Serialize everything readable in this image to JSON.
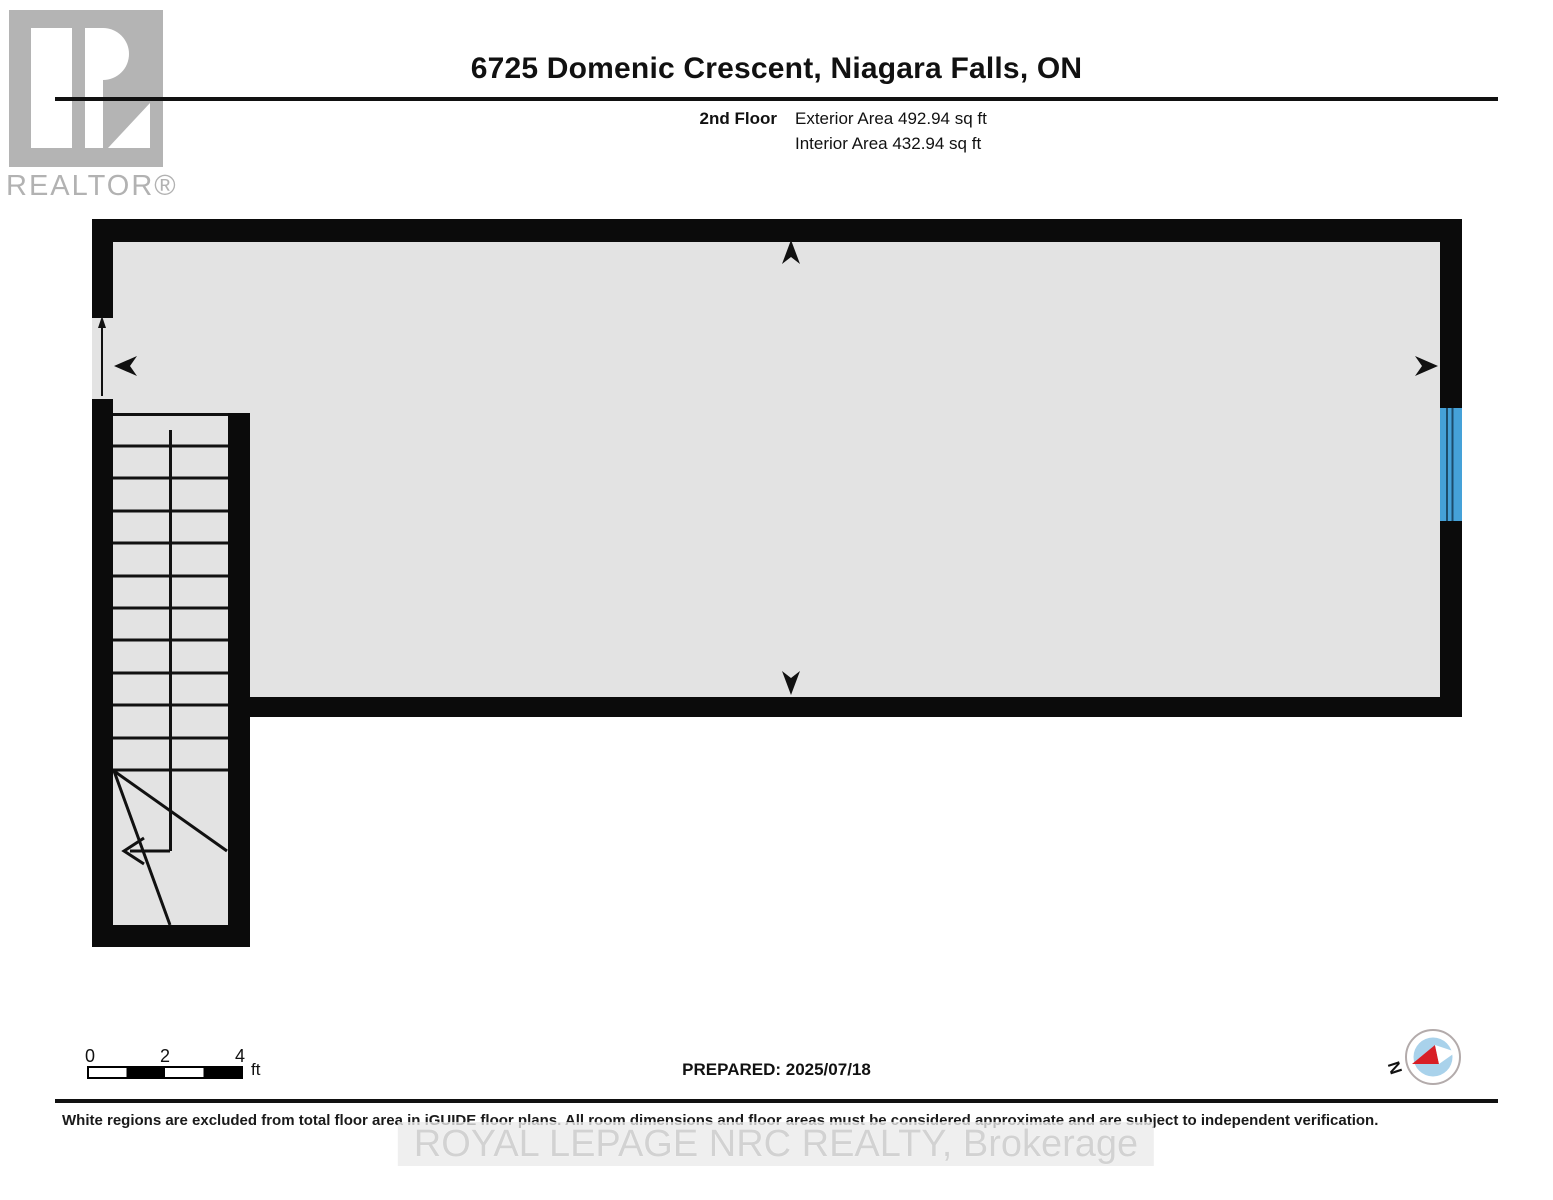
{
  "header": {
    "title": "6725 Domenic Crescent, Niagara Falls, ON",
    "floor_label": "2nd Floor",
    "exterior_area": "Exterior Area 492.94 sq ft",
    "interior_area": "Interior Area 432.94 sq ft"
  },
  "branding": {
    "logo_text": "REALTOR®"
  },
  "floor_plan": {
    "room": {
      "name": "ATTIC",
      "dimensions": "34'10\" x 11'11\"",
      "area": "388 sq ft"
    },
    "stair_label": "DN",
    "colors": {
      "wall": "#0b0b0b",
      "floor": "#e3e3e3",
      "window": "#45a1d8"
    }
  },
  "scale_bar": {
    "ticks": [
      "0",
      "2",
      "4"
    ],
    "unit": "ft"
  },
  "compass": {
    "north_label": "N"
  },
  "footer": {
    "prepared_label": "PREPARED: 2025/07/18",
    "disclaimer": "White regions are excluded from total floor area in iGUIDE floor plans. All room dimensions and floor areas must be considered approximate and are subject to independent verification.",
    "watermark": "ROYAL LEPAGE NRC REALTY, Brokerage"
  }
}
